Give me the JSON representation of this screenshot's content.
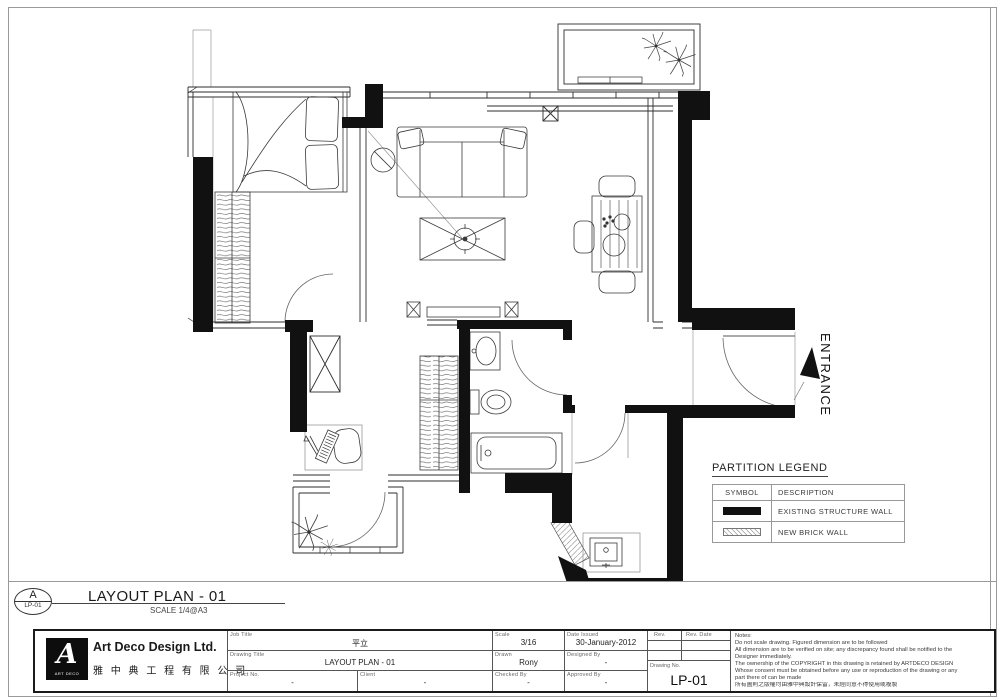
{
  "sheet": {
    "plan_callout": {
      "detail_letter": "A",
      "detail_ref": "LP-01",
      "title": "LAYOUT PLAN - 01",
      "scale": "SCALE 1/4@A3"
    },
    "entrance_label": "ENTRANCE",
    "legend": {
      "title": "PARTITION LEGEND",
      "columns": {
        "symbol": "SYMBOL",
        "description": "DESCRIPTION"
      },
      "rows": [
        {
          "symbol_type": "existing-structure-wall",
          "description": "EXISTING STRUCTURE WALL"
        },
        {
          "symbol_type": "new-brick-wall",
          "description": "NEW BRICK WALL"
        }
      ]
    },
    "title_block": {
      "company": {
        "name_en": "Art Deco Design Ltd.",
        "name_zh": "雅 中 典 工 程 有 限 公 司",
        "logo_letter": "A",
        "logo_caption": "ART DECO"
      },
      "job_title": {
        "label": "Job Title",
        "value": "平立"
      },
      "drawing_title": {
        "label": "Drawing Title",
        "value": "LAYOUT PLAN - 01"
      },
      "project_no": {
        "label": "Project No.",
        "value": "-"
      },
      "client": {
        "label": "Client",
        "value": "-"
      },
      "scale": {
        "label": "Scale",
        "value": "3/16"
      },
      "drawn": {
        "label": "Drawn",
        "value": "Rony"
      },
      "checked_by": {
        "label": "Checked By",
        "value": "-"
      },
      "date_issued": {
        "label": "Date Issued",
        "value": "30-January-2012"
      },
      "designed_by": {
        "label": "Designed By",
        "value": "-"
      },
      "approved_by": {
        "label": "Approved By",
        "value": "-"
      },
      "rev": {
        "label": "Rev."
      },
      "rev_date": {
        "label": "Rev. Date"
      },
      "drawing_no": {
        "label": "Drawing No.",
        "value": "LP-01"
      },
      "notes": {
        "title": "Notes:",
        "lines": [
          "Do not scale drawing. Figured dimension are to be followed",
          "All dimension are to be verified on site; any discrepancy found shall be notified to the",
          "Designer immediately.",
          "The ownership of the COPYRIGHT in this drawing is retained by ARTDECO DESIGN",
          "Whose consent must be obtained before any use or reproduction of the drawing or any",
          "part there of can be made",
          "所有圖則之版權均由雅中典設計保留，未經同意不得使用或複製"
        ]
      }
    }
  },
  "colors": {
    "wall": "#111111",
    "line": "#2b2b2b",
    "light_line": "#8a8a8a"
  }
}
